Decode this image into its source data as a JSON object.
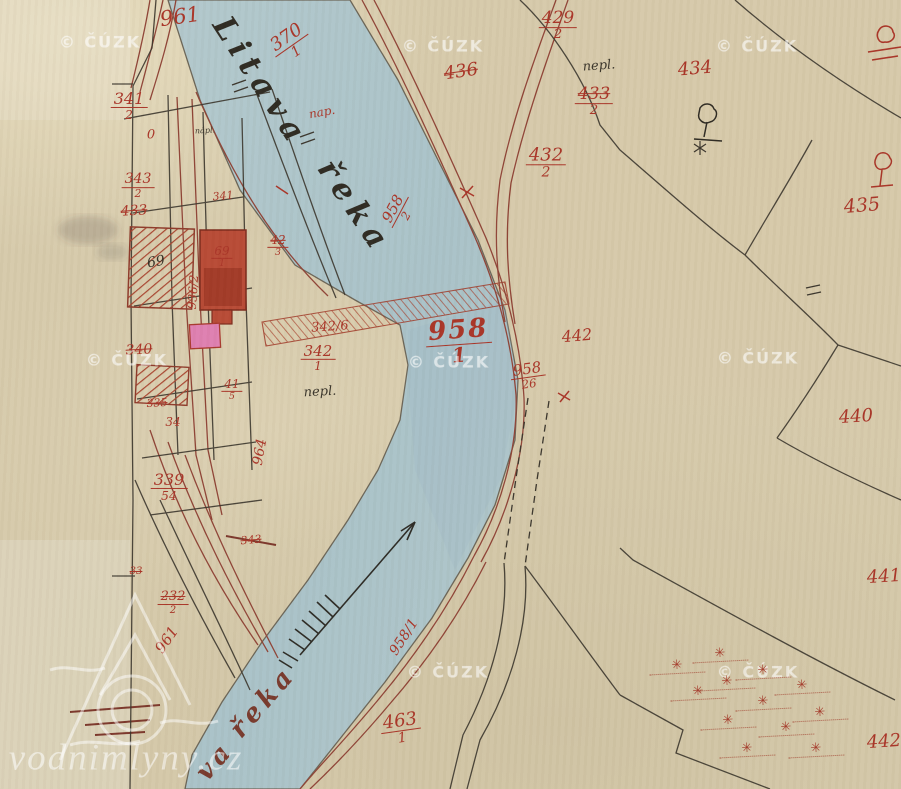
{
  "map": {
    "kind": "historical cadastral river map",
    "colors": {
      "paper": "#d6caab",
      "water": "#aec5ca",
      "ink_red": "#a93427",
      "ink_black": "#332f26",
      "ink_brown": "#78392c",
      "building_solid": "#b84a35",
      "building_pink": "#de7fb0",
      "watermark_white": "rgba(255,255,255,0.5)"
    },
    "labels": [
      {
        "t": "961",
        "x": 180,
        "y": 17,
        "r": -8,
        "s": 21,
        "c": "red"
      },
      {
        "t": "370",
        "d": "1",
        "x": 291,
        "y": 44,
        "r": -35,
        "s": 18,
        "c": "red"
      },
      {
        "t": "429",
        "d": "2",
        "x": 558,
        "y": 26,
        "r": 0,
        "s": 17,
        "c": "red"
      },
      {
        "t": "436",
        "x": 461,
        "y": 72,
        "r": -8,
        "s": 18,
        "c": "red struck"
      },
      {
        "t": "433",
        "d": "2",
        "x": 594,
        "y": 102,
        "r": 0,
        "s": 17,
        "c": "red struck"
      },
      {
        "t": "434",
        "x": 695,
        "y": 69,
        "r": -5,
        "s": 18,
        "c": "red"
      },
      {
        "t": "nepl.",
        "x": 599,
        "y": 66,
        "r": -4,
        "s": 13,
        "c": "black-it"
      },
      {
        "t": "435",
        "x": 862,
        "y": 206,
        "r": -5,
        "s": 19,
        "c": "red"
      },
      {
        "t": "432",
        "d": "2",
        "x": 546,
        "y": 163,
        "r": 0,
        "s": 18,
        "c": "red"
      },
      {
        "t": "958",
        "d": "2",
        "x": 399,
        "y": 212,
        "r": -62,
        "s": 15,
        "c": "red"
      },
      {
        "t": "958",
        "d": "1",
        "x": 459,
        "y": 341,
        "r": -4,
        "s": 26,
        "c": "red big"
      },
      {
        "t": "958",
        "d": "26",
        "x": 528,
        "y": 376,
        "r": -8,
        "s": 15,
        "c": "red"
      },
      {
        "t": "442",
        "x": 577,
        "y": 336,
        "r": -5,
        "s": 16,
        "c": "red"
      },
      {
        "t": "440",
        "x": 856,
        "y": 417,
        "r": -4,
        "s": 18,
        "c": "red"
      },
      {
        "t": "441",
        "x": 884,
        "y": 577,
        "r": -4,
        "s": 18,
        "c": "red"
      },
      {
        "t": "442",
        "x": 884,
        "y": 742,
        "r": -4,
        "s": 18,
        "c": "red"
      },
      {
        "t": "463",
        "d": "1",
        "x": 401,
        "y": 729,
        "r": -8,
        "s": 18,
        "c": "red"
      },
      {
        "t": "958/1",
        "x": 404,
        "y": 637,
        "r": -57,
        "s": 14,
        "c": "red"
      },
      {
        "t": "961",
        "x": 167,
        "y": 640,
        "r": -55,
        "s": 15,
        "c": "red"
      },
      {
        "t": "964",
        "x": 260,
        "y": 452,
        "r": -80,
        "s": 14,
        "c": "red"
      },
      {
        "t": "936/2",
        "x": 193,
        "y": 292,
        "r": -86,
        "s": 12,
        "c": "red"
      },
      {
        "t": "341",
        "d": "2",
        "x": 129,
        "y": 106,
        "r": 0,
        "s": 16,
        "c": "red"
      },
      {
        "t": "0",
        "x": 151,
        "y": 135,
        "r": 0,
        "s": 13,
        "c": "red"
      },
      {
        "t": "343",
        "d": "2",
        "x": 138,
        "y": 186,
        "r": 0,
        "s": 14,
        "c": "red"
      },
      {
        "t": "433",
        "x": 134,
        "y": 211,
        "r": -3,
        "s": 14,
        "c": "red struck"
      },
      {
        "t": "341",
        "x": 223,
        "y": 196,
        "r": -5,
        "s": 11,
        "c": "red"
      },
      {
        "t": "42",
        "d": "3",
        "x": 278,
        "y": 246,
        "r": 0,
        "s": 12,
        "c": "red struck"
      },
      {
        "t": "69",
        "d": "1",
        "x": 222,
        "y": 257,
        "r": 0,
        "s": 12,
        "c": "red"
      },
      {
        "t": "69",
        "x": 156,
        "y": 262,
        "r": -10,
        "s": 14,
        "c": "black"
      },
      {
        "t": "340",
        "x": 139,
        "y": 350,
        "r": -3,
        "s": 14,
        "c": "red struck"
      },
      {
        "t": "41",
        "d": "5",
        "x": 232,
        "y": 390,
        "r": 0,
        "s": 12,
        "c": "red"
      },
      {
        "t": "335",
        "x": 157,
        "y": 403,
        "r": -3,
        "s": 11,
        "c": "red struck"
      },
      {
        "t": "34",
        "x": 173,
        "y": 422,
        "r": 0,
        "s": 12,
        "c": "red"
      },
      {
        "t": "339",
        "d": "54",
        "x": 169,
        "y": 487,
        "r": 0,
        "s": 16,
        "c": "red"
      },
      {
        "t": "343",
        "x": 251,
        "y": 540,
        "r": -5,
        "s": 11,
        "c": "red struck"
      },
      {
        "t": "33",
        "x": 136,
        "y": 572,
        "r": 0,
        "s": 10,
        "c": "red struck"
      },
      {
        "t": "232",
        "d": "2",
        "x": 173,
        "y": 603,
        "r": 0,
        "s": 13,
        "c": "red struck"
      },
      {
        "t": "342/6",
        "x": 330,
        "y": 327,
        "r": -4,
        "s": 13,
        "c": "red"
      },
      {
        "t": "342",
        "d": "1",
        "x": 318,
        "y": 358,
        "r": 0,
        "s": 15,
        "c": "red"
      },
      {
        "t": "nap.",
        "x": 322,
        "y": 112,
        "r": -10,
        "s": 12,
        "c": "red-it"
      },
      {
        "t": "nápl.",
        "x": 205,
        "y": 131,
        "r": -3,
        "s": 8,
        "c": "black-it"
      },
      {
        "t": "nepl.",
        "x": 320,
        "y": 392,
        "r": -3,
        "s": 13,
        "c": "black-it"
      },
      {
        "t": "Litava",
        "x": 260,
        "y": 82,
        "r": 57,
        "s": 31,
        "c": "cursive"
      },
      {
        "t": "řeka",
        "x": 354,
        "y": 207,
        "r": 56,
        "s": 31,
        "c": "cursive"
      },
      {
        "t": "va",
        "x": 215,
        "y": 761,
        "r": -49,
        "s": 26,
        "c": "cursive-brown"
      },
      {
        "t": "řeka",
        "x": 263,
        "y": 702,
        "r": -49,
        "s": 26,
        "c": "cursive-brown"
      }
    ],
    "watermark": {
      "cuzk_text": "© ČÚZK",
      "cuzk_positions": [
        [
          100,
          42
        ],
        [
          443,
          46
        ],
        [
          757,
          46
        ],
        [
          127,
          360
        ],
        [
          449,
          362
        ],
        [
          758,
          358
        ],
        [
          448,
          672
        ],
        [
          758,
          672
        ]
      ],
      "site_text": "vodnimlyny.cz"
    },
    "symbols": {
      "bush_glyph": "✳",
      "bushes": [
        [
          720,
          655
        ],
        [
          677,
          667
        ],
        [
          763,
          672
        ],
        [
          727,
          683
        ],
        [
          698,
          693
        ],
        [
          802,
          687
        ],
        [
          763,
          703
        ],
        [
          820,
          714
        ],
        [
          728,
          722
        ],
        [
          786,
          729
        ],
        [
          747,
          750
        ],
        [
          816,
          750
        ]
      ]
    }
  }
}
